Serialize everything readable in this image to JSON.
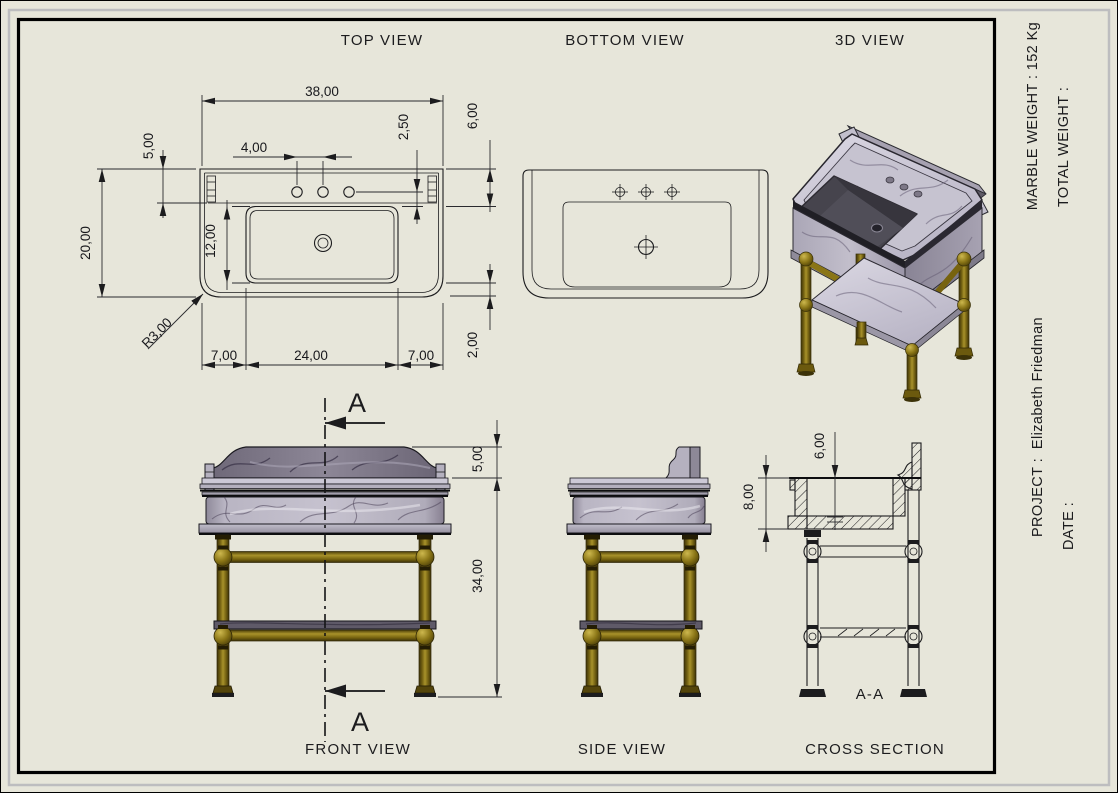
{
  "page": {
    "paper_color": "#e7e6da",
    "frame_color": "#000000",
    "shadow_color": "#bdbdbf"
  },
  "view_titles": {
    "top": "TOP VIEW",
    "bottom": "BOTTOM VIEW",
    "three_d": "3D VIEW",
    "front": "FRONT VIEW",
    "side": "SIDE VIEW",
    "cross_section": "CROSS SECTION"
  },
  "title_block": {
    "marble_weight": "MARBLE WEIGHT : 152 Kg",
    "total_weight": "TOTAL WEIGHT :",
    "project": "PROJECT :  Elizabeth Friedman",
    "date": "DATE :"
  },
  "top_view": {
    "dims": {
      "overall_width": "38,00",
      "splash_thickness": "5,00",
      "faucet_spacing": "4,00",
      "faucet_offset": "2,50",
      "deck_depth": "6,00",
      "overall_depth": "20,00",
      "basin_depth": "12,00",
      "corner_radius": "R3,00",
      "left_rim": "7,00",
      "basin_width": "24,00",
      "right_rim": "7,00",
      "wall_thickness": "2,00"
    }
  },
  "front_view": {
    "section_letter_top": "A",
    "section_letter_bottom": "A",
    "dims": {
      "splash_height": "5,00",
      "stand_height": "34,00"
    }
  },
  "cross_section_view": {
    "section_label": "A-A",
    "dims": {
      "bowl_depth": "6,00",
      "marble_height": "8,00"
    }
  },
  "materials": {
    "marble_light": "#bcb8c6",
    "marble_dark": "#77717f",
    "basin_interior": "#46444d",
    "brass": "#8a7516"
  }
}
